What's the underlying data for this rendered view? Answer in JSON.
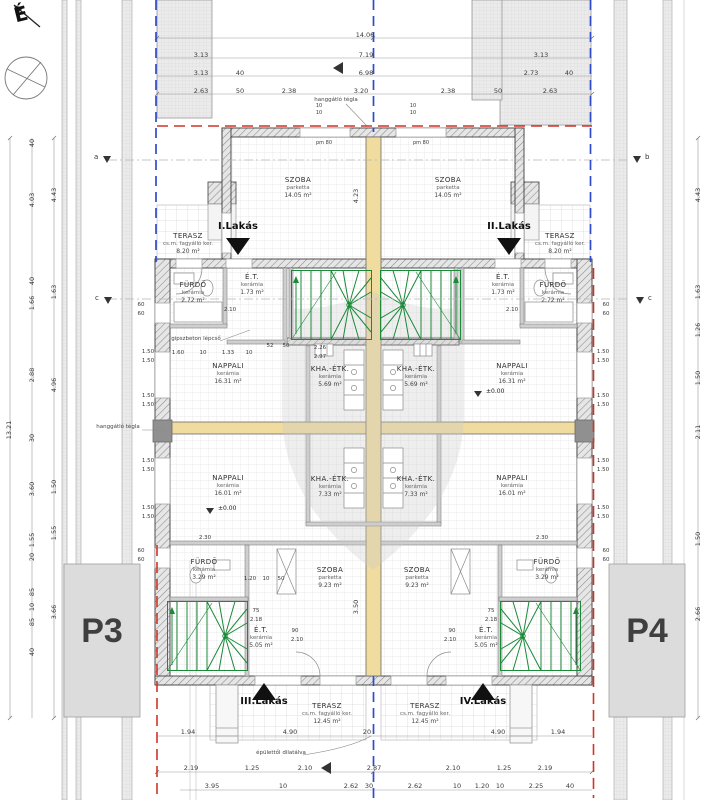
{
  "compass": {
    "north": "É"
  },
  "parcels": {
    "left": "P3",
    "right": "P4"
  },
  "units": {
    "i": "I.Lakás",
    "ii": "II.Lakás",
    "iii": "III.Lakás",
    "iv": "IV.Lakás"
  },
  "markers": {
    "a": "a",
    "b": "b",
    "c_left": "c",
    "c_right": "c"
  },
  "levels": {
    "zero": "±0.00"
  },
  "annotations": {
    "party_wall_top": "hanggátló tégla",
    "party_wall_left": "hanggátló tégla",
    "stair_note": "gipszbeton lépcső",
    "dilatation": "épülettől dilatálva"
  },
  "rooms": {
    "szoba_tl": {
      "name": "SZOBA",
      "finish": "parketta",
      "area": "14.05 m²"
    },
    "szoba_tr": {
      "name": "SZOBA",
      "finish": "parketta",
      "area": "14.05 m²"
    },
    "terasz_tl": {
      "name": "TERASZ",
      "finish": "cs.m. fagyálló ker.",
      "area": "8.20 m²"
    },
    "terasz_tr": {
      "name": "TERASZ",
      "finish": "cs.m. fagyálló ker.",
      "area": "8.20 m²"
    },
    "furdo_ml": {
      "name": "FÜRDŐ",
      "finish": "kerámia",
      "area": "2.72 m²"
    },
    "furdo_mr": {
      "name": "FÜRDŐ",
      "finish": "kerámia",
      "area": "2.72 m²"
    },
    "et_ml": {
      "name": "É.T.",
      "finish": "kerámia",
      "area": "1.73 m²"
    },
    "et_mr": {
      "name": "É.T.",
      "finish": "kerámia",
      "area": "1.73 m²"
    },
    "nappali_ul": {
      "name": "NAPPALI",
      "finish": "kerámia",
      "area": "16.31 m²"
    },
    "nappali_ur": {
      "name": "NAPPALI",
      "finish": "kerámia",
      "area": "16.31 m²"
    },
    "kha_ul": {
      "name": "KHA.-ÉTK.",
      "finish": "kerámia",
      "area": "5.69 m²"
    },
    "kha_ur": {
      "name": "KHA.-ÉTK.",
      "finish": "kerámia",
      "area": "5.69 m²"
    },
    "nappali_ll": {
      "name": "NAPPALI",
      "finish": "kerámia",
      "area": "16.01 m²"
    },
    "nappali_lr": {
      "name": "NAPPALI",
      "finish": "kerámia",
      "area": "16.01 m²"
    },
    "kha_ll": {
      "name": "KHA.-ÉTK.",
      "finish": "kerámia",
      "area": "7.33 m²"
    },
    "kha_lr": {
      "name": "KHA.-ÉTK.",
      "finish": "kerámia",
      "area": "7.33 m²"
    },
    "szoba_bl": {
      "name": "SZOBA",
      "finish": "parketta",
      "area": "9.23 m²"
    },
    "szoba_br": {
      "name": "SZOBA",
      "finish": "parketta",
      "area": "9.23 m²"
    },
    "furdo_bl": {
      "name": "FÜRDŐ",
      "finish": "kerámia",
      "area": "3.29 m²"
    },
    "furdo_br": {
      "name": "FÜRDŐ",
      "finish": "kerámia",
      "area": "3.29 m²"
    },
    "et_bl": {
      "name": "É.T.",
      "finish": "kerámia",
      "area": "5.05 m²"
    },
    "et_br": {
      "name": "É.T.",
      "finish": "kerámia",
      "area": "5.05 m²"
    },
    "terasz_bl": {
      "name": "TERASZ",
      "finish": "cs.m. fagyálló ker.",
      "area": "12.45 m²"
    },
    "terasz_br": {
      "name": "TERASZ",
      "finish": "cs.m. fagyálló ker.",
      "area": "12.45 m²"
    }
  },
  "dims": {
    "top_r1": "14.06",
    "top_r2": [
      "3.13",
      "7.19",
      "3.13"
    ],
    "top_r3": [
      "3.13",
      "40",
      "6.98",
      "40",
      "2.73"
    ],
    "top_r4": [
      "2.63",
      "50",
      "2.38",
      "3.20",
      "2.38",
      "50",
      "2.63"
    ],
    "bot_r1": [
      "1.94",
      "4.90",
      "20",
      "4.90",
      "1.94"
    ],
    "bot_r2": [
      "2.19",
      "1.25",
      "2.10",
      "2.87",
      "2.10",
      "1.25",
      "2.19"
    ],
    "bot_r3": [
      "3.95",
      "10",
      "2.62",
      "30",
      "2.62",
      "10",
      "1.20",
      "10",
      "2.25",
      "40"
    ],
    "left_total": "13.21",
    "left_mid": [
      "40",
      "4.03",
      "40",
      "1.66",
      "2.88",
      "30",
      "3.60",
      "1.55",
      "20",
      "85",
      "10",
      "85",
      "40"
    ],
    "left_inner": [
      "4.43",
      "1.63",
      "4.96",
      "1.50",
      "1.55",
      "3.66"
    ],
    "right_chain": [
      "4.43",
      "1.63",
      "1.26",
      "1.50",
      "2.11",
      "1.50",
      "2.66"
    ],
    "win": "1.50",
    "sixty": "60",
    "ten": "10",
    "inner": {
      "wing_h": "4.23",
      "pm80": "pm 80",
      "door_et": "2.10",
      "row1": [
        "1.60",
        "10",
        "1.33",
        "10"
      ],
      "stair": [
        "52",
        "50"
      ],
      "k1": "2.26",
      "k2": "2.97",
      "bath_w": "2.30",
      "row2": [
        "1.20",
        "10",
        "50"
      ],
      "door90": "90",
      "door210": "2.10",
      "d75": "75",
      "d218": "2.18",
      "szoba_h": "3.50"
    }
  }
}
